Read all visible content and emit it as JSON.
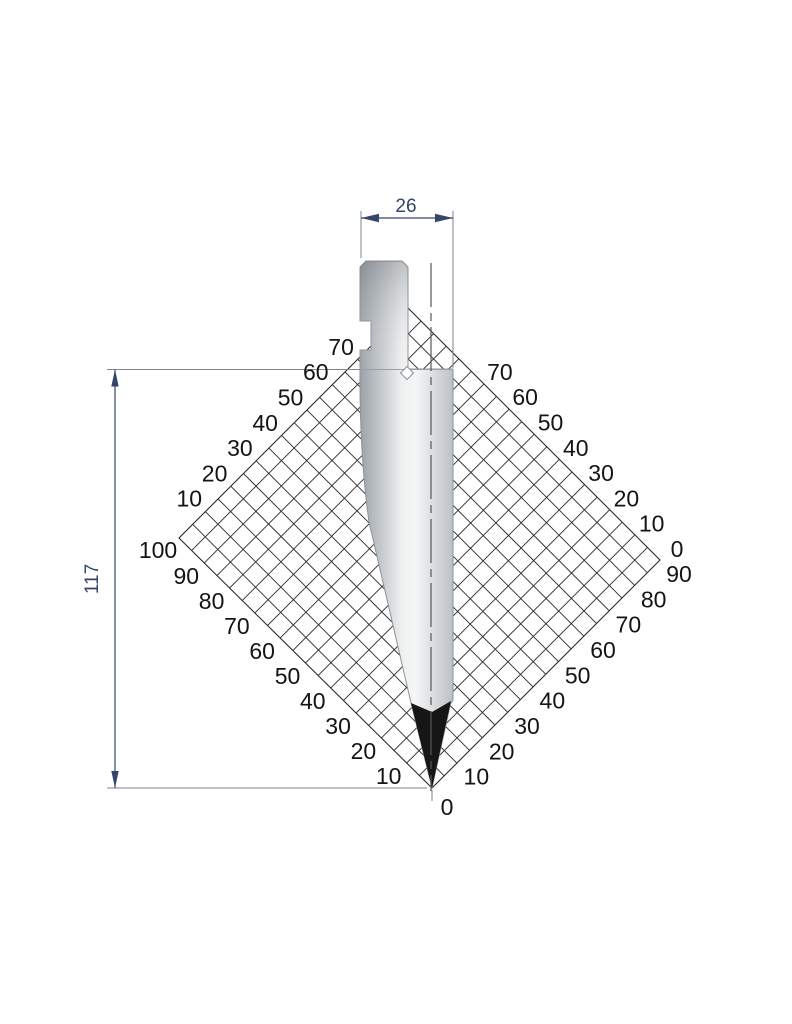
{
  "diagram": {
    "type": "press-brake-punch-technical-drawing",
    "dimensions": {
      "width_label": "26",
      "height_label": "117"
    },
    "scales": {
      "upper_left": [
        "70",
        "60",
        "50",
        "40",
        "30",
        "20",
        "10"
      ],
      "left_corner": "100",
      "lower_left": [
        "90",
        "80",
        "70",
        "60",
        "50",
        "40",
        "30",
        "20",
        "10"
      ],
      "bottom_corner": "0",
      "upper_right": [
        "70",
        "60",
        "50",
        "40",
        "30",
        "20",
        "10",
        "0"
      ],
      "lower_right": [
        "90",
        "80",
        "70",
        "60",
        "50",
        "40",
        "30",
        "20",
        "10"
      ]
    },
    "colors": {
      "dimension": "#35456b",
      "extension": "#7d8690",
      "grid_line": "#2b2b2b",
      "scale_label": "#141414",
      "punch_dark": "#9aa0a5",
      "punch_light": "#f5f6f6",
      "punch_tip": "#161616",
      "centerline": "#53585e"
    }
  }
}
